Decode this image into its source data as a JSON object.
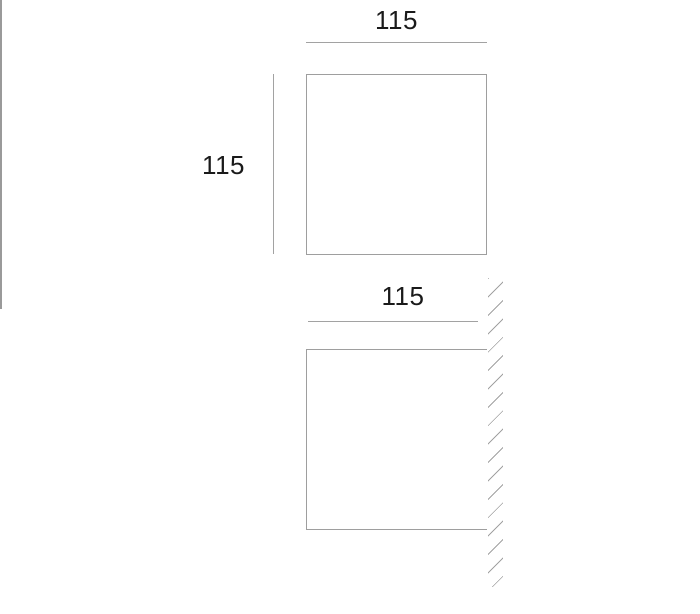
{
  "title": "Fixture dimension drawing",
  "colors": {
    "background": "#ffffff",
    "line": "#a2a2a2",
    "wall_line": "#9a9a9a",
    "text": "#1a1a1a"
  },
  "front_view": {
    "width_label": "115",
    "height_label": "115"
  },
  "side_view": {
    "depth_label": "115"
  }
}
